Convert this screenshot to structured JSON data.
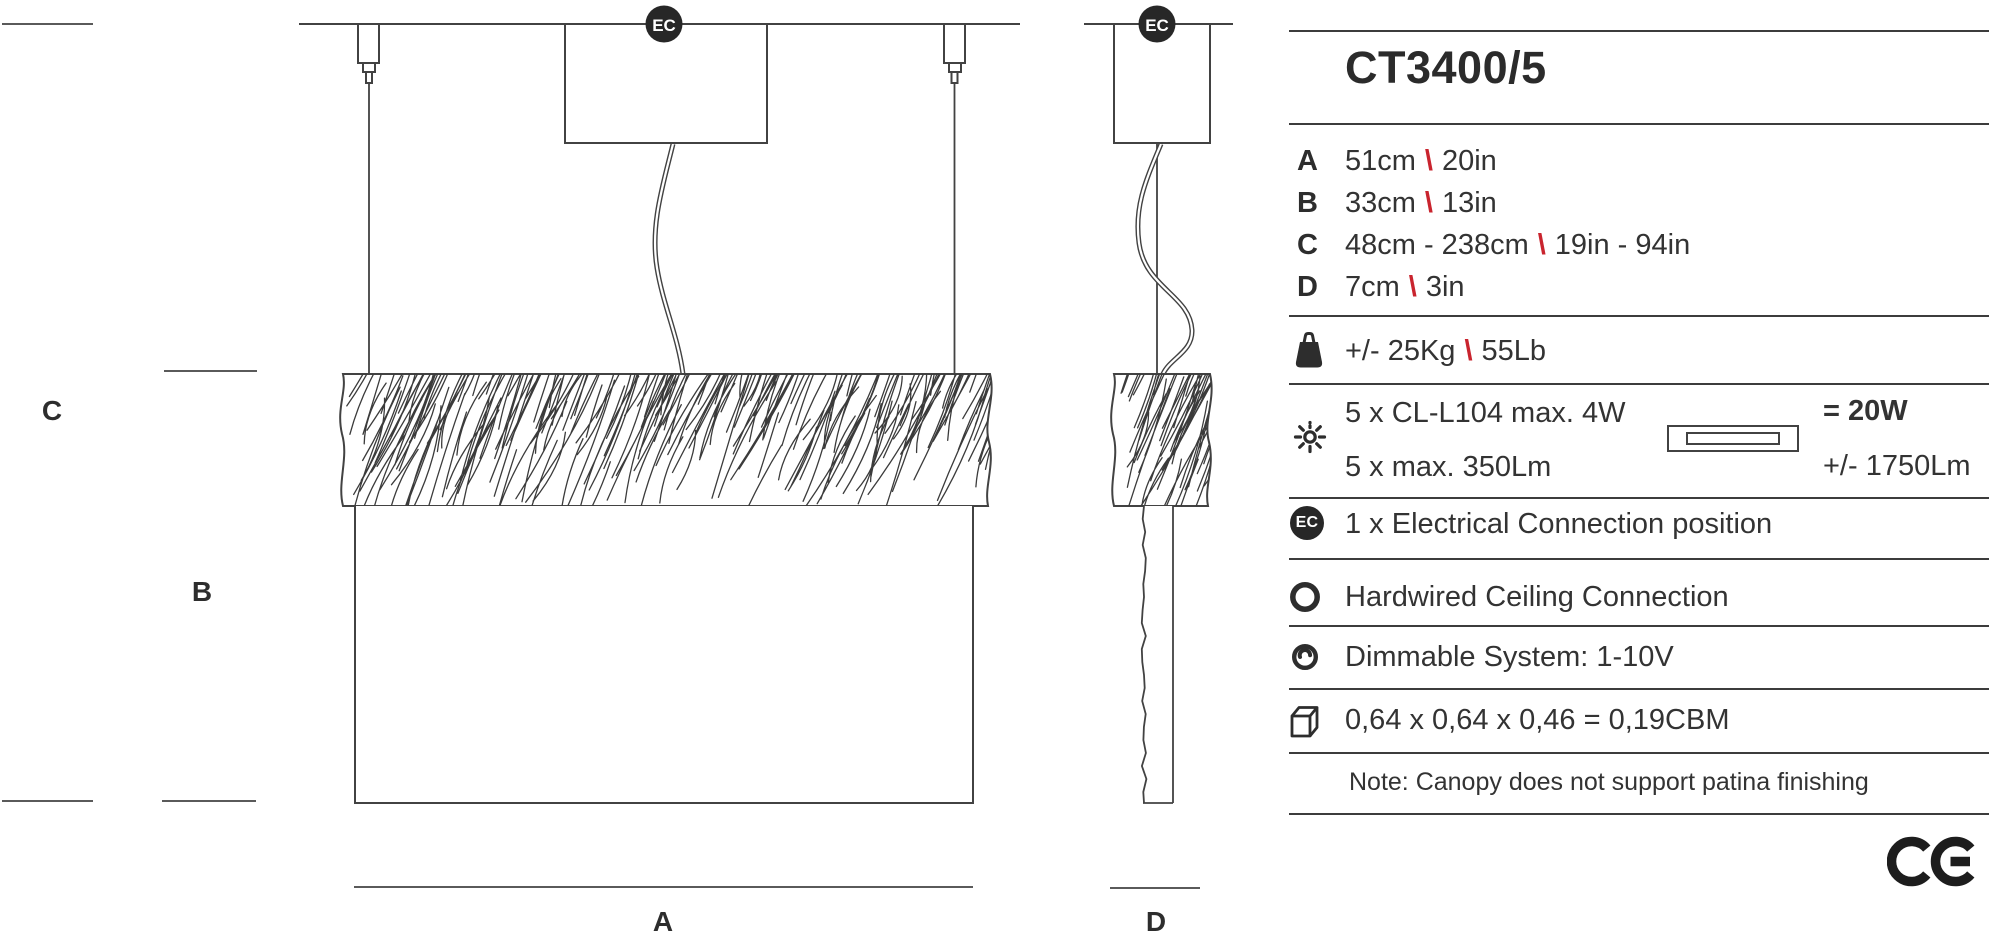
{
  "colors": {
    "ink": "#424242",
    "text": "#333333",
    "accent_red": "#c9242e",
    "badge": "#272727",
    "background": "#ffffff"
  },
  "drawing": {
    "ec_badge_label": "EC",
    "labels": {
      "width": "A",
      "shade_height": "B",
      "drop": "C",
      "depth": "D"
    }
  },
  "panel": {
    "title": "CT3400/5",
    "dimensions": [
      {
        "key": "A",
        "metric": "51cm",
        "sep": "\\",
        "imperial": "20in"
      },
      {
        "key": "B",
        "metric": "33cm",
        "sep": "\\",
        "imperial": "13in"
      },
      {
        "key": "C",
        "metric": "48cm - 238cm",
        "sep": "\\",
        "imperial": "19in - 94in"
      },
      {
        "key": "D",
        "metric": "7cm",
        "sep": "\\",
        "imperial": "3in"
      }
    ],
    "weight": {
      "metric": "+/- 25Kg",
      "sep": "\\",
      "imperial": "55Lb"
    },
    "lamp": {
      "line1": "5 x CL-L104 max. 4W",
      "line2": "5 x max. 350Lm",
      "total_watt": "= 20W",
      "total_lumen": "+/- 1750Lm"
    },
    "features": [
      {
        "icon": "ec-icon",
        "text": "1 x Electrical Connection position"
      },
      {
        "icon": "ring-icon",
        "text": "Hardwired Ceiling Connection"
      },
      {
        "icon": "dimmer-icon",
        "text": "Dimmable System: 1-10V"
      },
      {
        "icon": "box-icon",
        "text": "0,64 x 0,64 x 0,46 = 0,19CBM"
      }
    ],
    "note": "Note: Canopy does not support patina finishing"
  }
}
